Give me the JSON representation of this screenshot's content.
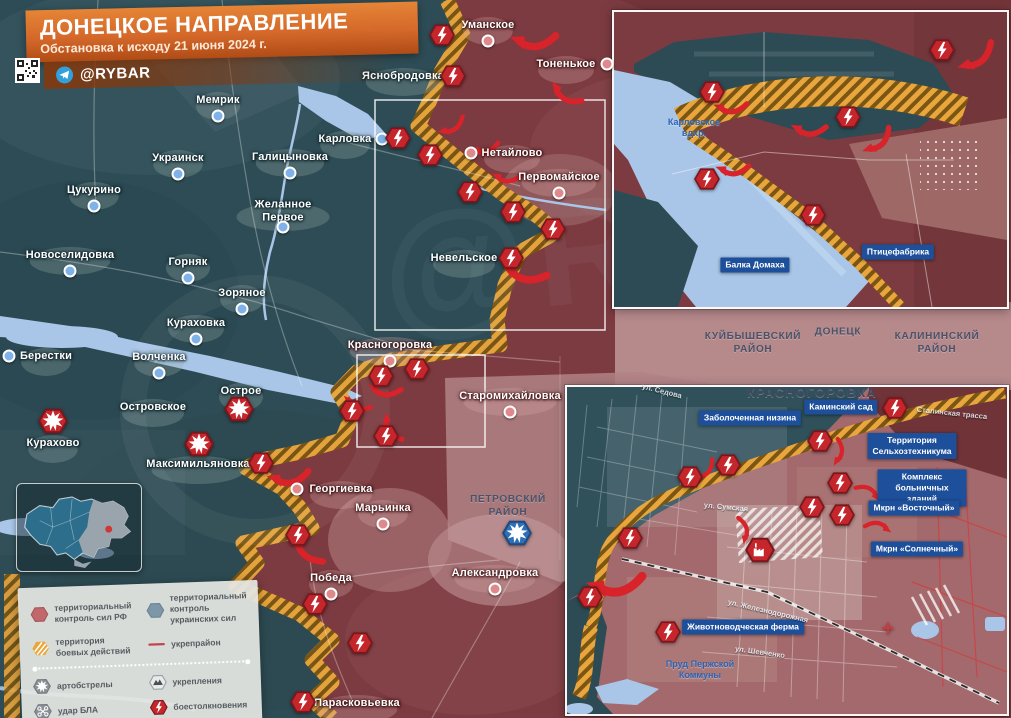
{
  "title": {
    "heading": "ДОНЕЦКОЕ НАПРАВЛЕНИЕ",
    "subtitle": "Обстановка к исходу 21 июня 2024 г."
  },
  "brand": {
    "channel": "@RYBAR"
  },
  "colors": {
    "ru_control": "#7c3b40",
    "ua_control": "#2e4c55",
    "combat_zone": "#e8a63c",
    "water": "#a9c6e8",
    "clash_red": "#c5262c",
    "badge_blue": "#1d4f9b",
    "banner_orange": "#d4682a"
  },
  "watermark": "@RYBAR",
  "districts": [
    {
      "label": "КУЙБЫШЕВСКИЙ\nРАЙОН",
      "x": 753,
      "y": 343
    },
    {
      "label": "ДОНЕЦК",
      "x": 838,
      "y": 332
    },
    {
      "label": "КАЛИНИНСКИЙ\nРАЙОН",
      "x": 937,
      "y": 343
    },
    {
      "label": "ПЕТРОВСКИЙ\nРАЙОН",
      "x": 508,
      "y": 506
    }
  ],
  "inset_south_title": {
    "label": "КРАСНОГОРОВКА",
    "x": 812,
    "y": 393
  },
  "settlements": [
    {
      "name": "Мемрик",
      "x": 218,
      "y": 100,
      "side": "ua",
      "dot": "b"
    },
    {
      "name": "Яснобродовка",
      "x": 403,
      "y": 76,
      "side": "ua",
      "dot": ""
    },
    {
      "name": "Уманское",
      "x": 488,
      "y": 25,
      "side": "ru",
      "dot": "b"
    },
    {
      "name": "Тоненькое",
      "x": 566,
      "y": 64,
      "side": "ru",
      "dot": "r"
    },
    {
      "name": "Украинск",
      "x": 178,
      "y": 158,
      "side": "ua",
      "dot": "b"
    },
    {
      "name": "Галицыновка",
      "x": 290,
      "y": 157,
      "side": "ua",
      "dot": "b"
    },
    {
      "name": "Карловка",
      "x": 345,
      "y": 139,
      "side": "ua",
      "dot": "r"
    },
    {
      "name": "Нетайлово",
      "x": 512,
      "y": 153,
      "side": "ru",
      "dot": "l"
    },
    {
      "name": "Первомайское",
      "x": 559,
      "y": 177,
      "side": "ru",
      "dot": "b"
    },
    {
      "name": "Цукурино",
      "x": 94,
      "y": 190,
      "side": "ua",
      "dot": "b"
    },
    {
      "name": "Желанное Первое",
      "x": 283,
      "y": 211,
      "side": "ua",
      "dot": "b",
      "w": 72
    },
    {
      "name": "Новоселидовка",
      "x": 70,
      "y": 255,
      "side": "ua",
      "dot": "b"
    },
    {
      "name": "Горняк",
      "x": 188,
      "y": 262,
      "side": "ua",
      "dot": "b"
    },
    {
      "name": "Зоряное",
      "x": 242,
      "y": 293,
      "side": "ua",
      "dot": "b"
    },
    {
      "name": "Невельское",
      "x": 464,
      "y": 258,
      "side": "ua",
      "dot": ""
    },
    {
      "name": "Кураховка",
      "x": 196,
      "y": 323,
      "side": "ua",
      "dot": "b"
    },
    {
      "name": "Берестки",
      "x": 46,
      "y": 356,
      "side": "ua",
      "dot": "l"
    },
    {
      "name": "Волченка",
      "x": 159,
      "y": 357,
      "side": "ua",
      "dot": "b"
    },
    {
      "name": "Красногоровка",
      "x": 390,
      "y": 345,
      "side": "ru",
      "dot": "b"
    },
    {
      "name": "Острое",
      "x": 241,
      "y": 391,
      "side": "ua",
      "dot": ""
    },
    {
      "name": "Островское",
      "x": 153,
      "y": 407,
      "side": "ua",
      "dot": ""
    },
    {
      "name": "Старомихайловка",
      "x": 510,
      "y": 396,
      "side": "ru",
      "dot": "b"
    },
    {
      "name": "Курахово",
      "x": 53,
      "y": 443,
      "side": "ua",
      "dot": ""
    },
    {
      "name": "Максимильяновка",
      "x": 198,
      "y": 464,
      "side": "ua",
      "dot": ""
    },
    {
      "name": "Георгиевка",
      "x": 341,
      "y": 489,
      "side": "ru",
      "dot": "l"
    },
    {
      "name": "Марьинка",
      "x": 383,
      "y": 508,
      "side": "ru",
      "dot": "b"
    },
    {
      "name": "Победа",
      "x": 331,
      "y": 578,
      "side": "ru",
      "dot": "b"
    },
    {
      "name": "Александровка",
      "x": 495,
      "y": 573,
      "side": "ru",
      "dot": "b"
    },
    {
      "name": "Парасковьевка",
      "x": 357,
      "y": 703,
      "side": "ru",
      "dot": ""
    }
  ],
  "badges": [
    {
      "label": "Балка Домаха",
      "x": 755,
      "y": 265
    },
    {
      "label": "Птицефабрика",
      "x": 898,
      "y": 252
    },
    {
      "label": "Заболоченная низина",
      "x": 750,
      "y": 418
    },
    {
      "label": "Каминский сад",
      "x": 841,
      "y": 407
    },
    {
      "label": "Территория\nСельхозтехникума",
      "x": 912,
      "y": 446
    },
    {
      "label": "Комплекс\nбольничных зданий",
      "x": 922,
      "y": 488
    },
    {
      "label": "Мкрн «Восточный»",
      "x": 914,
      "y": 508
    },
    {
      "label": "Мкрн «Солнечный»",
      "x": 917,
      "y": 549
    },
    {
      "label": "Животноводческая ферма",
      "x": 743,
      "y": 627
    }
  ],
  "streets": [
    {
      "label": "ул. Седова",
      "x": 662,
      "y": 391,
      "rot": 14
    },
    {
      "label": "ул. Сумская",
      "x": 726,
      "y": 507,
      "rot": 5
    },
    {
      "label": "ул. Железнодорожная",
      "x": 768,
      "y": 611,
      "rot": 13
    },
    {
      "label": "ул. Шевченко",
      "x": 760,
      "y": 652,
      "rot": 8
    },
    {
      "label": "Сталинская трасса",
      "x": 952,
      "y": 413,
      "rot": 6
    }
  ],
  "water_labels": [
    {
      "label": "Карловское\nвдхр.",
      "x": 694,
      "y": 128
    },
    {
      "label": "Пруд Пержской\nКоммуны",
      "x": 700,
      "y": 670
    }
  ],
  "markers": [
    {
      "type": "clash",
      "x": 442,
      "y": 35
    },
    {
      "type": "clash",
      "x": 453,
      "y": 76
    },
    {
      "type": "clash",
      "x": 398,
      "y": 138
    },
    {
      "type": "clash",
      "x": 430,
      "y": 155
    },
    {
      "type": "clash",
      "x": 470,
      "y": 192
    },
    {
      "type": "clash",
      "x": 513,
      "y": 212
    },
    {
      "type": "clash",
      "x": 553,
      "y": 229
    },
    {
      "type": "clash",
      "x": 511,
      "y": 258
    },
    {
      "type": "clash",
      "x": 417,
      "y": 369
    },
    {
      "type": "clash",
      "x": 381,
      "y": 376
    },
    {
      "type": "clash",
      "x": 352,
      "y": 411
    },
    {
      "type": "clash",
      "x": 386,
      "y": 436
    },
    {
      "type": "clash",
      "x": 261,
      "y": 463
    },
    {
      "type": "clash",
      "x": 298,
      "y": 535
    },
    {
      "type": "clash",
      "x": 315,
      "y": 604
    },
    {
      "type": "clash",
      "x": 360,
      "y": 643
    },
    {
      "type": "clash",
      "x": 303,
      "y": 702
    },
    {
      "type": "shelling",
      "x": 53,
      "y": 421
    },
    {
      "type": "shelling",
      "x": 199,
      "y": 444
    },
    {
      "type": "shelling",
      "x": 239,
      "y": 409
    },
    {
      "type": "shelling_blue",
      "x": 517,
      "y": 533
    },
    {
      "type": "clash",
      "x": 942,
      "y": 50
    },
    {
      "type": "clash",
      "x": 712,
      "y": 92
    },
    {
      "type": "clash",
      "x": 848,
      "y": 117
    },
    {
      "type": "clash",
      "x": 707,
      "y": 179
    },
    {
      "type": "clash",
      "x": 813,
      "y": 215
    },
    {
      "type": "clash",
      "x": 895,
      "y": 408
    },
    {
      "type": "clash",
      "x": 820,
      "y": 441
    },
    {
      "type": "clash",
      "x": 728,
      "y": 465
    },
    {
      "type": "clash",
      "x": 690,
      "y": 477
    },
    {
      "type": "clash",
      "x": 840,
      "y": 483
    },
    {
      "type": "clash",
      "x": 812,
      "y": 507
    },
    {
      "type": "clash",
      "x": 842,
      "y": 515
    },
    {
      "type": "clash",
      "x": 630,
      "y": 538
    },
    {
      "type": "clash",
      "x": 590,
      "y": 597
    },
    {
      "type": "clash",
      "x": 668,
      "y": 632
    },
    {
      "type": "factory",
      "x": 760,
      "y": 550
    },
    {
      "type": "cross",
      "x": 888,
      "y": 628
    }
  ],
  "arrows": [
    {
      "x": 534,
      "y": 40,
      "a": 195,
      "s": 1.1
    },
    {
      "x": 566,
      "y": 94,
      "a": 230,
      "s": 0.85
    },
    {
      "x": 452,
      "y": 126,
      "a": 165,
      "s": 0.7
    },
    {
      "x": 485,
      "y": 148,
      "a": 185,
      "s": 0.7
    },
    {
      "x": 507,
      "y": 177,
      "a": 200,
      "s": 0.7
    },
    {
      "x": 524,
      "y": 272,
      "a": 215,
      "s": 1.15
    },
    {
      "x": 385,
      "y": 390,
      "a": 205,
      "s": 0.8
    },
    {
      "x": 357,
      "y": 404,
      "a": 220,
      "s": 0.7
    },
    {
      "x": 392,
      "y": 428,
      "a": 255,
      "s": 0.75
    },
    {
      "x": 289,
      "y": 477,
      "a": 190,
      "s": 1.0
    },
    {
      "x": 307,
      "y": 549,
      "a": 245,
      "s": 1.0
    },
    {
      "x": 977,
      "y": 57,
      "a": 160,
      "s": 1.0
    },
    {
      "x": 731,
      "y": 107,
      "a": 195,
      "s": 0.8
    },
    {
      "x": 809,
      "y": 129,
      "a": 200,
      "s": 0.85
    },
    {
      "x": 878,
      "y": 141,
      "a": 155,
      "s": 0.85
    },
    {
      "x": 733,
      "y": 169,
      "a": 195,
      "s": 0.8
    },
    {
      "x": 616,
      "y": 584,
      "a": 190,
      "s": 1.35
    },
    {
      "x": 705,
      "y": 470,
      "a": 150,
      "s": 0.65
    },
    {
      "x": 838,
      "y": 452,
      "a": 115,
      "s": 0.65
    },
    {
      "x": 868,
      "y": 492,
      "a": 45,
      "s": 0.65
    },
    {
      "x": 743,
      "y": 530,
      "a": 95,
      "s": 0.65
    },
    {
      "x": 878,
      "y": 527,
      "a": 30,
      "s": 0.65
    }
  ],
  "legend": {
    "items": [
      {
        "icon": "hex-ru",
        "label": "территориальный контроль сил РФ"
      },
      {
        "icon": "hex-ua",
        "label": "территориальный контроль украинских сил"
      },
      {
        "icon": "hex-combat",
        "label": "территория боевых действий"
      },
      {
        "icon": "line-fort",
        "label": "укрепрайон"
      },
      {
        "icon": "shelling",
        "label": "артобстрелы"
      },
      {
        "icon": "fortification",
        "label": "укрепления"
      },
      {
        "icon": "drone",
        "label": "удар БЛА"
      },
      {
        "icon": "clash",
        "label": "боестолкновения"
      }
    ]
  }
}
